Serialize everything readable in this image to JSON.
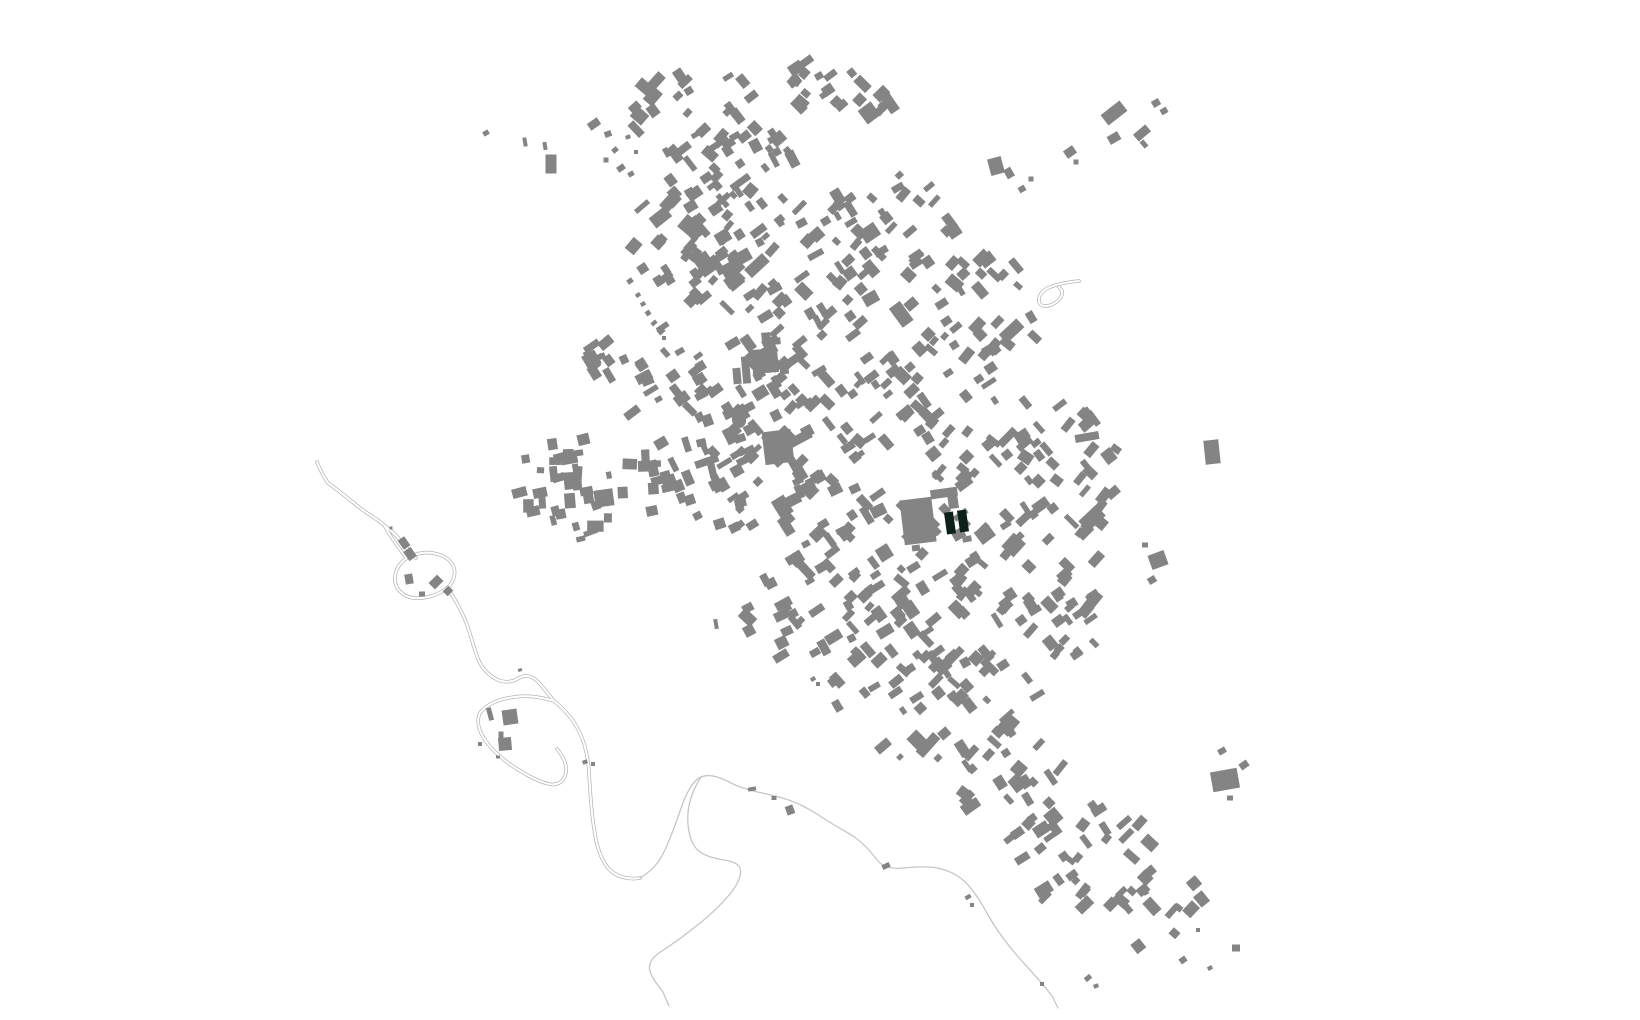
{
  "map": {
    "description": "figure-ground-map-of-village",
    "background_color": "#ffffff",
    "building_color": "#848484",
    "highlight_color": "#0d2019",
    "road_casing_color": "#b5b5b5",
    "road_inner_color": "#ffffff",
    "path_color": "#c6c6c6",
    "highlight_buildings": [
      [
        950,
        523,
        9,
        22,
        -8
      ],
      [
        963,
        521,
        9,
        22,
        -8
      ]
    ],
    "landmark_buildings": [
      [
        737,
        376,
        8,
        16,
        -5
      ],
      [
        746,
        370,
        8,
        27,
        -5
      ],
      [
        765,
        361,
        26,
        24,
        -5
      ],
      [
        784,
        367,
        9,
        14,
        -5
      ],
      [
        766,
        337,
        9,
        9,
        -5
      ],
      [
        777,
        341,
        7,
        7,
        -5
      ],
      [
        778,
        447,
        29,
        33,
        -7
      ],
      [
        918,
        521,
        32,
        45,
        -7
      ],
      [
        916,
        548,
        8,
        6,
        -7
      ],
      [
        944,
        493,
        27,
        9,
        -8
      ],
      [
        953,
        501,
        10,
        15,
        -8
      ],
      [
        604,
        498,
        19,
        17,
        -8
      ],
      [
        967,
        539,
        9,
        6,
        -10
      ],
      [
        705,
        264,
        16,
        22,
        -35
      ]
    ],
    "oval_buildings": [
      {
        "cx": 739,
        "cy": 420,
        "rx": 7,
        "ry": 8,
        "rot": -15
      }
    ],
    "outlier_buildings": [
      [
        486,
        133,
        6,
        5,
        -30
      ],
      [
        525,
        142,
        4,
        9,
        -10
      ],
      [
        545,
        146,
        4,
        8,
        -10
      ],
      [
        551,
        164,
        11,
        19,
        0
      ],
      [
        594,
        124,
        12,
        8,
        -35
      ],
      [
        608,
        134,
        7,
        6,
        -20
      ],
      [
        615,
        150,
        6,
        5,
        -40
      ],
      [
        606,
        160,
        5,
        5,
        0
      ],
      [
        621,
        168,
        8,
        6,
        -35
      ],
      [
        631,
        174,
        6,
        5,
        -30
      ],
      [
        636,
        152,
        4,
        4,
        0
      ],
      [
        628,
        137,
        5,
        4,
        -20
      ],
      [
        630,
        281,
        6,
        5,
        -35
      ],
      [
        638,
        295,
        5,
        4,
        -35
      ],
      [
        643,
        304,
        5,
        4,
        -30
      ],
      [
        648,
        313,
        5,
        5,
        -35
      ],
      [
        654,
        323,
        6,
        4,
        -40
      ],
      [
        661,
        331,
        7,
        6,
        -40
      ],
      [
        664,
        338,
        4,
        4,
        0
      ],
      [
        1114,
        113,
        24,
        13,
        -38
      ],
      [
        1156,
        103,
        8,
        7,
        -30
      ],
      [
        1164,
        111,
        7,
        6,
        -30
      ],
      [
        1142,
        133,
        16,
        9,
        -40
      ],
      [
        1144,
        144,
        5,
        8,
        -40
      ],
      [
        1114,
        138,
        12,
        9,
        -30
      ],
      [
        1070,
        152,
        11,
        9,
        -35
      ],
      [
        1076,
        162,
        5,
        5,
        0
      ],
      [
        996,
        166,
        14,
        17,
        -15
      ],
      [
        1009,
        173,
        8,
        10,
        -30
      ],
      [
        1022,
        189,
        7,
        6,
        -30
      ],
      [
        1031,
        179,
        5,
        5,
        0
      ],
      [
        1212,
        452,
        15,
        24,
        -6
      ],
      [
        1087,
        437,
        24,
        8,
        -10
      ],
      [
        1158,
        560,
        17,
        15,
        -20
      ],
      [
        1152,
        580,
        8,
        7,
        -30
      ],
      [
        1145,
        545,
        6,
        5,
        0
      ],
      [
        1225,
        780,
        27,
        20,
        -10
      ],
      [
        1222,
        751,
        8,
        6,
        -30
      ],
      [
        1244,
        765,
        9,
        7,
        -35
      ],
      [
        1230,
        798,
        6,
        5,
        0
      ],
      [
        928,
        745,
        26,
        10,
        -48
      ],
      [
        917,
        740,
        14,
        16,
        -45
      ],
      [
        883,
        746,
        16,
        9,
        -40
      ],
      [
        900,
        757,
        6,
        5,
        -45
      ],
      [
        938,
        758,
        7,
        6,
        -45
      ],
      [
        752,
        789,
        8,
        4,
        -10
      ],
      [
        774,
        798,
        5,
        4,
        0
      ],
      [
        790,
        810,
        8,
        9,
        -20
      ],
      [
        886,
        866,
        8,
        5,
        -25
      ],
      [
        1143,
        890,
        12,
        9,
        -40
      ],
      [
        1183,
        960,
        7,
        6,
        -35
      ],
      [
        1198,
        930,
        4,
        4,
        0
      ],
      [
        1236,
        948,
        8,
        7,
        0
      ],
      [
        1210,
        968,
        5,
        4,
        -30
      ],
      [
        1088,
        978,
        7,
        5,
        -40
      ],
      [
        1096,
        986,
        5,
        4,
        -20
      ],
      [
        1042,
        984,
        4,
        4,
        0
      ],
      [
        968,
        897,
        6,
        4,
        -30
      ],
      [
        972,
        905,
        4,
        4,
        0
      ],
      [
        409,
        579,
        8,
        10,
        -10
      ],
      [
        436,
        582,
        12,
        9,
        -45
      ],
      [
        448,
        591,
        8,
        7,
        -45
      ],
      [
        422,
        594,
        6,
        5,
        0
      ],
      [
        404,
        543,
        8,
        11,
        -35
      ],
      [
        410,
        554,
        9,
        11,
        -35
      ],
      [
        391,
        528,
        3,
        3,
        0
      ],
      [
        510,
        717,
        15,
        15,
        -8
      ],
      [
        490,
        714,
        5,
        13,
        -15
      ],
      [
        505,
        744,
        13,
        13,
        -5
      ],
      [
        501,
        735,
        5,
        7,
        0
      ],
      [
        480,
        744,
        4,
        4,
        0
      ],
      [
        498,
        757,
        4,
        3,
        0
      ],
      [
        520,
        670,
        4,
        3,
        -20
      ],
      [
        585,
        762,
        5,
        4,
        -20
      ],
      [
        593,
        764,
        4,
        4,
        0
      ],
      [
        716,
        624,
        4,
        10,
        -10
      ],
      [
        752,
        631,
        6,
        5,
        -30
      ],
      [
        813,
        679,
        5,
        4,
        -30
      ],
      [
        818,
        684,
        4,
        4,
        0
      ]
    ],
    "clusters": [
      [
        690,
        115,
        72,
        52,
        30,
        -40,
        11
      ],
      [
        755,
        175,
        70,
        58,
        34,
        -38,
        12
      ],
      [
        818,
        88,
        42,
        30,
        14,
        -40,
        13
      ],
      [
        860,
        100,
        30,
        26,
        8,
        -40,
        14
      ],
      [
        692,
        240,
        64,
        66,
        42,
        -42,
        15
      ],
      [
        795,
        268,
        88,
        66,
        46,
        -38,
        16
      ],
      [
        900,
        242,
        85,
        70,
        40,
        -40,
        17
      ],
      [
        992,
        302,
        58,
        55,
        22,
        -40,
        18
      ],
      [
        640,
        366,
        62,
        48,
        28,
        -32,
        19
      ],
      [
        748,
        398,
        78,
        66,
        40,
        -36,
        20
      ],
      [
        862,
        382,
        88,
        76,
        48,
        -40,
        21
      ],
      [
        975,
        402,
        76,
        86,
        46,
        -42,
        22
      ],
      [
        1068,
        468,
        55,
        72,
        30,
        -45,
        23
      ],
      [
        592,
        482,
        80,
        45,
        34,
        -6,
        24
      ],
      [
        702,
        472,
        55,
        55,
        26,
        -22,
        25
      ],
      [
        802,
        502,
        80,
        70,
        45,
        -36,
        26
      ],
      [
        912,
        562,
        80,
        75,
        45,
        -40,
        27
      ],
      [
        1030,
        565,
        75,
        65,
        38,
        -42,
        28
      ],
      [
        1060,
        625,
        45,
        40,
        16,
        -42,
        29
      ],
      [
        812,
        612,
        70,
        55,
        30,
        -36,
        30
      ],
      [
        882,
        672,
        68,
        55,
        28,
        -38,
        31
      ],
      [
        985,
        700,
        60,
        58,
        28,
        -40,
        32
      ],
      [
        1012,
        782,
        55,
        60,
        26,
        -42,
        33
      ],
      [
        1082,
        852,
        70,
        60,
        30,
        -42,
        34
      ],
      [
        1152,
        908,
        55,
        40,
        14,
        -42,
        35
      ],
      [
        562,
        512,
        40,
        33,
        12,
        -10,
        36
      ]
    ],
    "roads_outlined": [
      "M 317,462 C 320,470 324,477 328,483 C 338,490 350,500 360,508 C 368,514 377,519 384,525 C 391,537 399,549 407,558 C 399,563 394,572 395,581 C 396,590 404,597 414,598 C 426,599 438,595 447,588 C 453,583 456,575 454,568 C 452,561 445,556 437,554 C 427,551 416,553 407,558 M 384,525 C 392,531 400,539 407,548 L 416,558 M 447,588 C 454,597 460,608 466,622 C 472,638 474,650 479,661 C 483,670 490,676 498,680 C 505,683 513,682 519,678 C 526,674 532,676 538,682 C 544,688 549,695 554,701 C 541,697 527,695 514,697 C 500,699 486,704 480,713 C 476,721 479,731 485,740 C 492,750 501,758 511,765 C 523,773 536,781 549,784 C 558,786 565,781 566,772 C 567,764 563,756 557,749 M 554,701 C 564,709 573,719 579,731 C 585,743 588,757 589,772 C 590,790 591,810 594,828 C 596,844 600,858 608,868 C 616,877 628,880 640,878",
      "M 1079,281 C 1068,282 1057,284 1048,288 C 1042,291 1038,296 1039,302 C 1040,306 1045,307 1051,305 C 1058,302 1063,297 1062,291 L 1059,287"
    ],
    "roads_thin": [
      "M 640,878 C 650,872 658,864 663,854 C 670,840 677,820 684,800 C 690,786 695,780 701,777 C 710,773 722,778 733,784 C 748,791 764,793 779,797 C 794,801 808,808 820,816 C 832,824 843,830 853,836 C 862,842 871,852 878,861 C 884,868 893,869 903,868 C 914,867 926,866 937,868 C 947,870 956,874 963,880 C 972,888 980,900 988,915 C 996,929 1004,940 1014,952 C 1026,966 1040,980 1052,996 L 1058,1008",
      "M 701,777 C 694,788 689,800 688,813 C 687,825 689,838 695,847 C 701,855 712,858 724,860 C 731,861 738,863 740,868 C 742,875 738,884 730,894 C 720,906 708,917 695,927 C 684,936 671,945 659,953 C 652,958 648,964 650,971 C 652,979 658,985 663,992 L 669,1006"
    ]
  }
}
